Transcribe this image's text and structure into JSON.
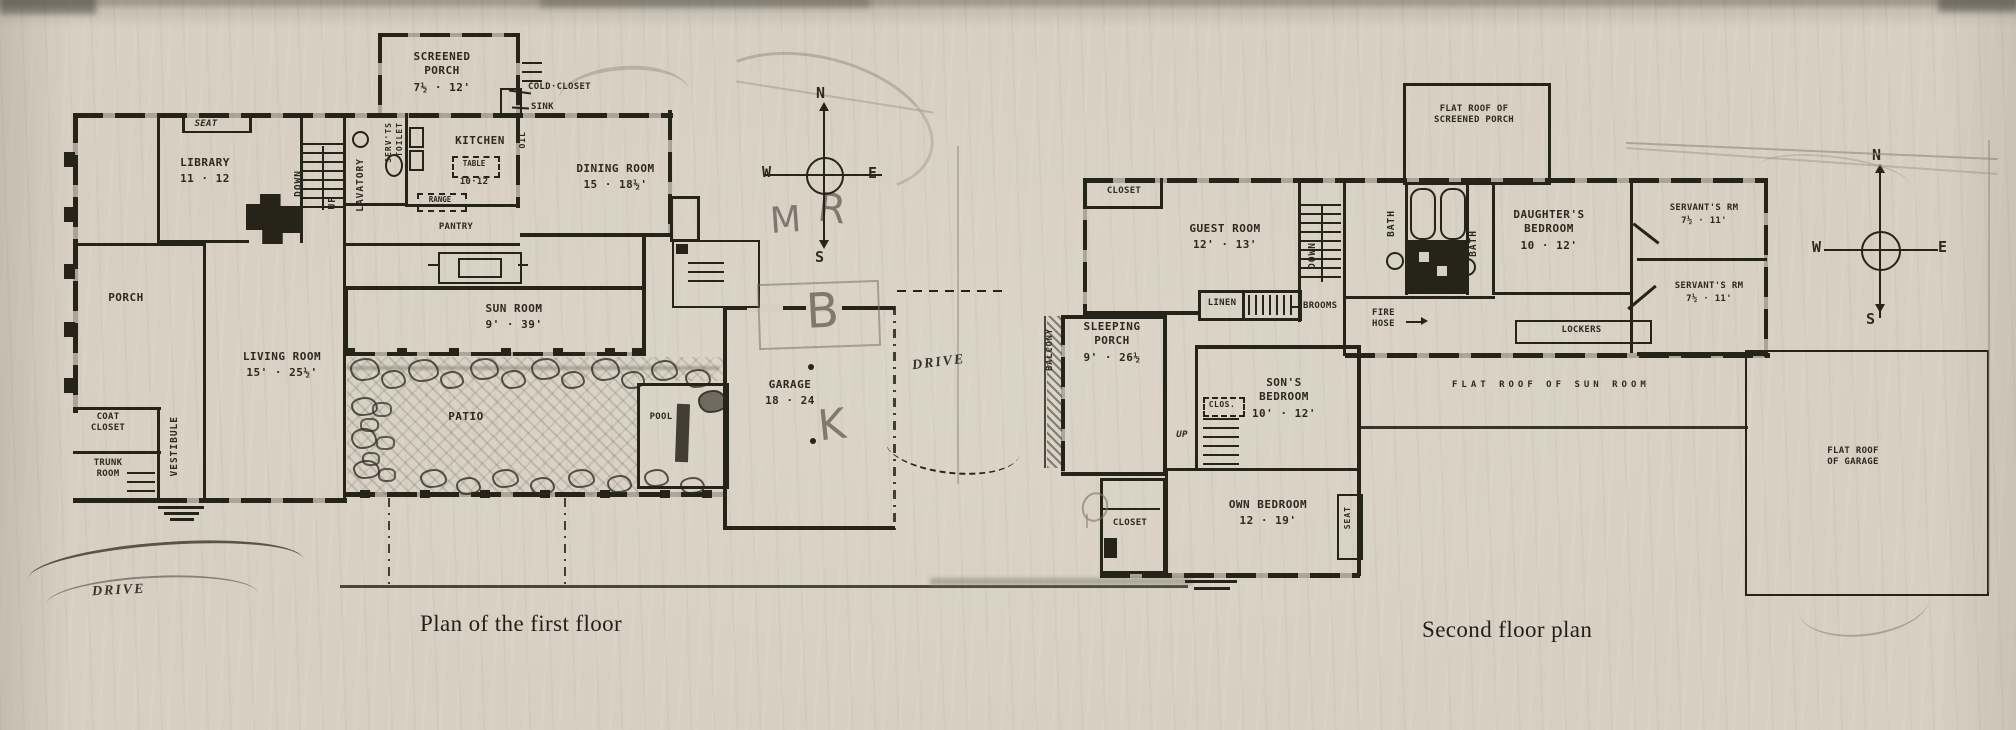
{
  "colors": {
    "paper": "#d7d0c2",
    "ink": "#262419",
    "pencil": "#8e897c"
  },
  "captions": {
    "first_floor": "Plan of the first floor",
    "second_floor": "Second floor plan"
  },
  "first_floor": {
    "screened_porch": {
      "name": "SCREENED PORCH",
      "dims": "7½ · 12'"
    },
    "cold_closet": "COLD·CLOSET",
    "sink": "SINK",
    "kitchen": {
      "name": "KITCHEN",
      "table": "TABLE",
      "table_dims": "10·12"
    },
    "oil": "OIL",
    "range": "RANGE",
    "dining_room": {
      "name": "DINING ROOM",
      "dims": "15 · 18½'"
    },
    "seat": "SEAT",
    "library": {
      "name": "LIBRARY",
      "dims": "11 · 12"
    },
    "lavatory": "LAVATORY",
    "servants_toilet": {
      "line1": "SERV'TS",
      "line2": "TOILET"
    },
    "down": "DOWN",
    "up": "UP",
    "pantry": "PANTRY",
    "porch": "PORCH",
    "living_room": {
      "name": "LIVING ROOM",
      "dims": "15' · 25½'"
    },
    "sun_room": {
      "name": "SUN ROOM",
      "dims": "9' · 39'"
    },
    "coat_closet": "COAT CLOSET",
    "trunk_room": "TRUNK ROOM",
    "vestibule": "VESTIBULE",
    "patio": "PATIO",
    "pool": "POOL",
    "garage": {
      "name": "GARAGE",
      "dims": "18 · 24"
    },
    "drive_court": "DRIVE",
    "drive_front": "DRIVE",
    "compass": {
      "n": "N",
      "e": "E",
      "s": "S",
      "w": "W"
    },
    "pencil": {
      "m": "M",
      "r": "R",
      "b": "B",
      "k": "K"
    }
  },
  "second_floor": {
    "flat_roof_screened_porch": "FLAT ROOF OF SCREENED PORCH",
    "closet_top": "CLOSET",
    "guest_room": {
      "name": "GUEST ROOM",
      "dims": "12' · 13'"
    },
    "down": "DOWN",
    "bath_left": "BATH",
    "bath_right": "BATH",
    "daughters_bedroom": {
      "name": "DAUGHTER'S BEDROOM",
      "dims": "10 · 12'"
    },
    "servants_room_upper": {
      "name": "SERVANT'S RM",
      "dims": "7½ · 11'"
    },
    "servants_room_lower": {
      "name": "SERVANT'S RM",
      "dims": "7½ · 11'"
    },
    "linen": "LINEN",
    "brooms": "BROOMS",
    "fire_hose": "FIRE HOSE",
    "lockers": "LOCKERS",
    "sleeping_porch": {
      "name": "SLEEPING PORCH",
      "dims": "9' · 26½"
    },
    "balcony": "BALCONY",
    "sons_bedroom": {
      "name": "SON'S BEDROOM",
      "dims": "10' · 12'"
    },
    "clos": "CLOS.",
    "up": "UP",
    "own_bedroom": {
      "name": "OWN BEDROOM",
      "dims": "12 · 19'"
    },
    "closet_bottom": "CLOSET",
    "seat": "SEAT",
    "flat_roof_sun_room": "FLAT ROOF OF SUN ROOM",
    "flat_roof_garage": "FLAT ROOF OF GARAGE",
    "compass": {
      "n": "N",
      "e": "E",
      "s": "S",
      "w": "W"
    }
  }
}
